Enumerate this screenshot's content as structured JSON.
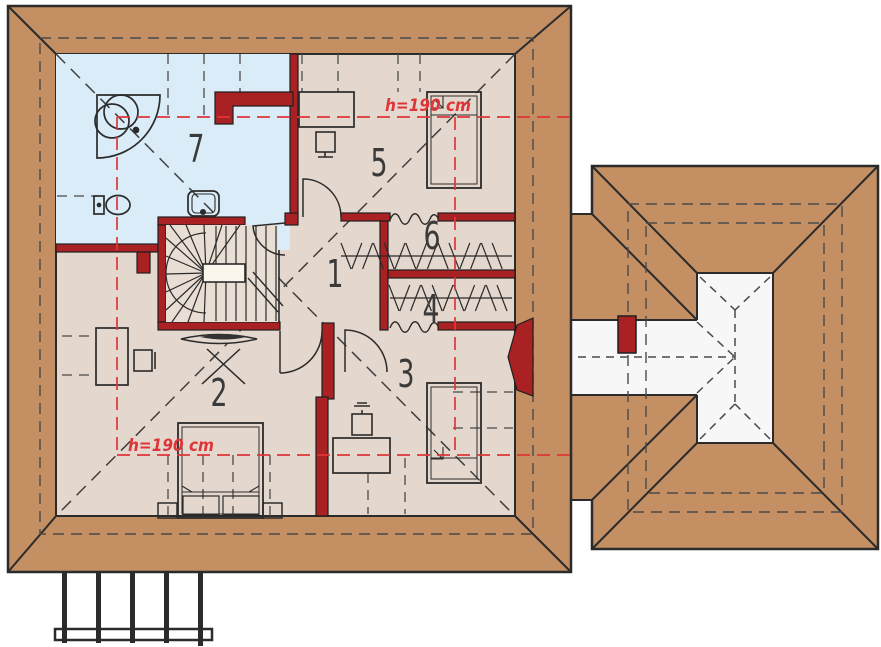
{
  "plan": {
    "rooms": [
      {
        "number": "1"
      },
      {
        "number": "2"
      },
      {
        "number": "3"
      },
      {
        "number": "4"
      },
      {
        "number": "5"
      },
      {
        "number": "6"
      },
      {
        "number": "7"
      }
    ],
    "height_labels": [
      "h=190 cm",
      "h=190 cm"
    ],
    "colors": {
      "roof_brown": "#C38F63",
      "floor_beige": "#E4D7CD",
      "bathroom_blue": "#D9ECF8",
      "wall_red": "#A92123",
      "flat_roof_white": "#F7F7F7",
      "height_line_red": "#E03538",
      "line_dark": "#2B2B2B"
    }
  }
}
